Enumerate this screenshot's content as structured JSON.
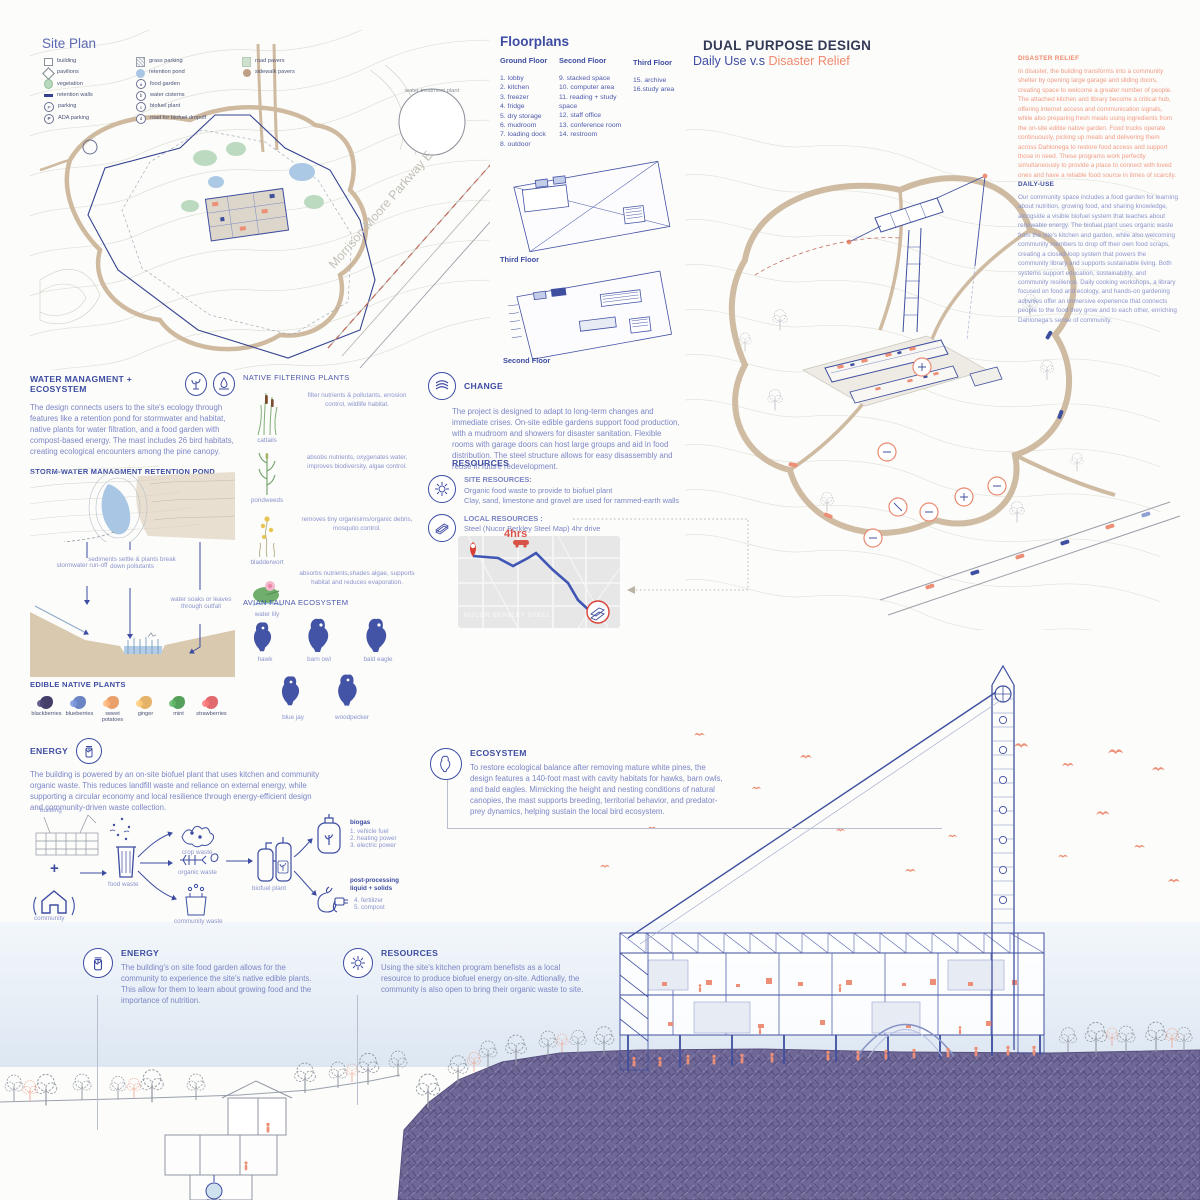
{
  "colors": {
    "navy": "#3d4ca2",
    "salmon": "#ee8a6f",
    "tan": "#cdb89e",
    "purple": "#6f6795",
    "pond_blue": "#a9c7e4"
  },
  "site_plan": {
    "title": "Site Plan",
    "legend_col1": [
      "building",
      "pavilions",
      "vegetation",
      "retention walls",
      "parking",
      "ADA parking"
    ],
    "legend_col2": [
      "grass parking",
      "retention pond",
      "food garden",
      "water cisterns",
      "biofuel plant",
      "road for biofuel dropoff"
    ],
    "legend_col3": [
      "road pavers",
      "sidewalk pavers"
    ],
    "legend_letters": [
      "a",
      "b",
      "c",
      "d"
    ],
    "water_treatment": "water treatment plant",
    "street": "Morrison Moore Parkway E"
  },
  "floorplans": {
    "title": "Floorplans",
    "ground_label": "Ground Floor",
    "ground_items": [
      "1. lobby",
      "2. kitchen",
      "3. freezer",
      "4. fridge",
      "5. dry storage",
      "6. mudroom",
      "7. loading dock",
      "8. outdoor"
    ],
    "second_label": "Second Floor",
    "second_items": [
      "9. stacked space",
      "10. computer area",
      "11. reading + study space",
      "12. staff office",
      "13. conference room",
      "14. restroom"
    ],
    "third_label": "Third Floor",
    "third_items": [
      "15. archive",
      "16.study area"
    ],
    "drawing_label_third": "Third Floor",
    "drawing_label_second": "Second Floor"
  },
  "dual": {
    "title": "DUAL PURPOSE DESIGN",
    "subtitle_blue": "Daily Use v.s",
    "subtitle_accent": "Disaster Relief",
    "disaster_heading": "DISASTER RELIEF",
    "disaster_body": "In disaster, the building transforms into a community shelter by opening large garage and sliding doors, creating space to welcome a greater number of people. The attached kitchen and library become a critical hub, offering internet access and communication signals, while also preparing fresh meals using ingredients from the on-site edible native garden. Food trucks operate continuously, picking up meals and delivering them across Dahlonega to restore food access and support those in need. These programs work perfectly simultaneously to provide a place to connect with loved ones and have a reliable food source in times of scarcity.",
    "daily_heading": "DAILY-USE",
    "daily_body": "Our community space includes a food garden for learning about nutrition, growing food, and sharing knowledge, alongside a visible biofuel system that teaches about renewable energy. The biofuel plant uses organic waste from the site's kitchen and garden, while also welcoming community members to drop off their own food scraps, creating a closed-loop system that powers the community library and supports sustainable living. Both systems support education, sustainability, and community resilience. Daily cooking workshops, a library focused on food and ecology, and hands-on gardening activities offer an immersive experience that connects people to the food they grow and to each other, enriching Dahlonega's sense of community."
  },
  "water": {
    "heading": "WATER MANAGMENT + ECOSYSTEM",
    "body": "The design connects users to the site's ecology through features like a retention pond for stormwater and habitat, native plants for water filtration, and a food garden with compost-based energy. The mast includes 26 bird habitats, creating ecological encounters among the pine canopy.",
    "sub": "STORM-WATER MANAGMENT RETENTION POND",
    "label_runoff": "stormwater run-off",
    "label_sediments": "sediments settle & plants break down pollutants",
    "label_outfall": "water soaks or leaves through outfall"
  },
  "filtering": {
    "heading": "NATIVE FILTERING PLANTS",
    "items": [
      {
        "name": "cattails",
        "desc": "filter nutrients & pollutants, errosion control, wildlife habitat."
      },
      {
        "name": "pondweeds",
        "desc": "absobs nutrients, oxygenates water, improves biodiversity, algae control."
      },
      {
        "name": "bladderwort",
        "desc": "removes tiny organisims/organic debris, mosquito control."
      },
      {
        "name": "water lily",
        "desc": "absorbs nutrients,shades algae, supports habitat and reduces evaporation."
      }
    ]
  },
  "avian": {
    "heading": "AVIAN FAUNA ECOSYSTEM",
    "birds": [
      "hawk",
      "barn owl",
      "bald eagle",
      "blue jay",
      "woodpecker"
    ]
  },
  "edible": {
    "heading": "EDIBLE NATIVE PLANTS",
    "items": [
      {
        "label": "blackberries",
        "color": "#433f68"
      },
      {
        "label": "blueberries",
        "color": "#6b85c4"
      },
      {
        "label": "sweet potatoes",
        "color": "#e9a06b"
      },
      {
        "label": "ginger",
        "color": "#e5b269"
      },
      {
        "label": "mint",
        "color": "#55a15c"
      },
      {
        "label": "strawberries",
        "color": "#e06a6d"
      }
    ]
  },
  "change": {
    "heading": "CHANGE",
    "body": "The project is designed to adapt to long-term changes and immediate crises. On-site edible gardens support food production, with a mudroom and showers for disaster sanitation. Flexible rooms with garage doors can host large groups and aid in food distribution. The steel structure allows for easy disassembly and reuse in future redevelopment."
  },
  "resources": {
    "heading": "RESOURCES",
    "site_label": "SITE RESOURCES:",
    "site_line1": "Organic food waste to provide to biofuel plant",
    "site_line2": "Clay, sand, limestone and gravel are used for rammed-earth walls",
    "local_label": "LOCAL RESOURCES :",
    "local_line": "Steel (Nucor Berkley Steel Map) 4hr drive"
  },
  "nucor": {
    "drive_time": "4hrs",
    "label": "NUCOR BERKLEY STEEL"
  },
  "energy": {
    "heading": "ENERGY",
    "body": "The building is powered by an on-site biofuel plant that uses kitchen and community organic waste. This reduces landfill waste and reliance on external energy, while supporting a circular economy and local resilience through energy-efficient design and community-driven waste collection."
  },
  "bioflow": {
    "building": "building",
    "plus": "+",
    "community": "community",
    "food_waste": "food waste",
    "crop_waste": "crop waste",
    "organic_waste": "organic waste",
    "community_waste": "community waste",
    "biofuel_plant": "biofuel plant",
    "biogas_title": "biogas",
    "biogas_items": [
      "1. vehicle fuel",
      "2. heating power",
      "3. electric power"
    ],
    "post_title": "post-processing liquid + solids",
    "post_items": [
      "4. fertilizer",
      "5. compost"
    ]
  },
  "ecosystem": {
    "heading": "ECOSYSTEM",
    "body": "To restore ecological balance after removing mature white pines, the design features a 140-foot mast with cavity habitats for hawks, barn owls, and bald eagles. Mimicking the height and nesting conditions of natural canopies, the mast supports breeding, territorial behavior, and predator-prey dynamics, helping sustain the local bird ecosystem."
  },
  "bottom_energy": {
    "heading": "ENERGY",
    "body": "The building's on site food garden allows for the community to experience the site's native edible plants. This allow for them to learn about growing food and the importance of nutrition."
  },
  "bottom_resources": {
    "heading": "RESOURCES",
    "body": "Using the site's kitchen program benefists as a local resource to produce biofuel energy on-site. Adtionally, the community is also open to bring their organic waste to site."
  }
}
